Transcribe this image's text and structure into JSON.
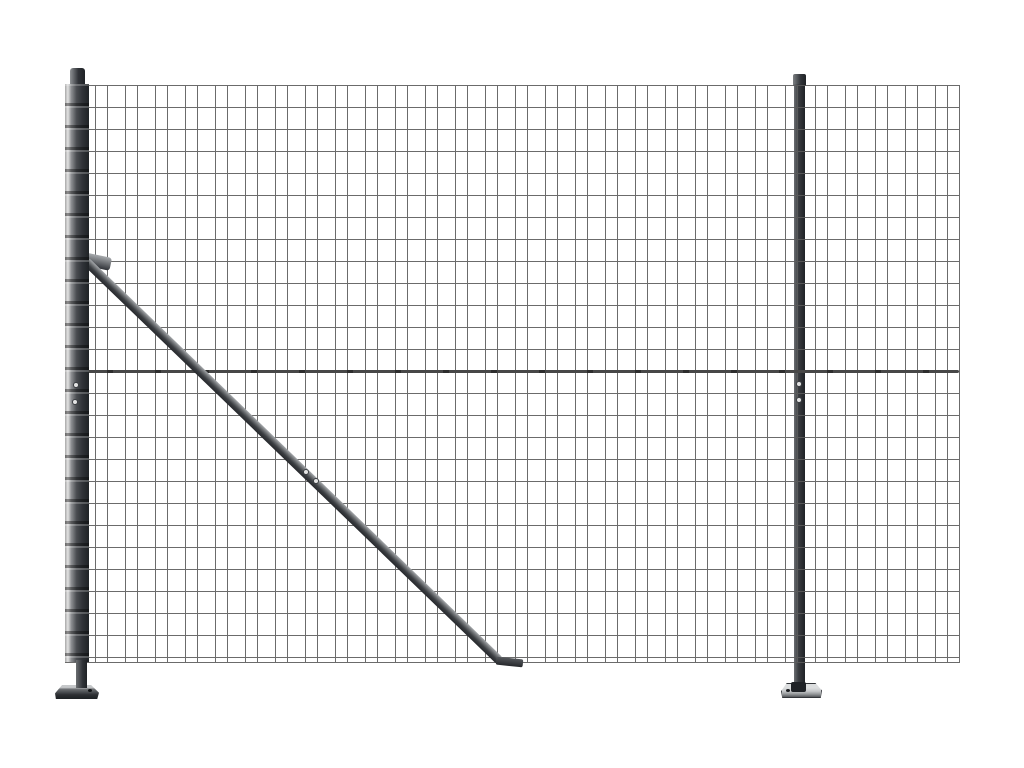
{
  "scene": {
    "type": "product-photo",
    "subject": "anthracite wire mesh fence panel with two posts, flange feet and a diagonal ground brace",
    "background": "#ffffff"
  },
  "colors": {
    "bg": "#ffffff",
    "wire": "#5c5c5c",
    "tension": "#474747",
    "tension_dark": "#2d2d2d",
    "post_light": "#e3e3e3",
    "post_dark": "#303338",
    "post_darker": "#1f2226",
    "brace_light": "#a7aaad",
    "brace_dark": "#26282c",
    "flange_light": "#c6c8ca",
    "flange_dark": "#2c2f33",
    "bolt": "#e4e4e4"
  },
  "mesh": {
    "columns_pattern": "paired vertical wires, pair gap 12px, period 30px",
    "row_spacing_px": 22,
    "panel": {
      "left": 65,
      "top": 85,
      "width": 894,
      "height": 577
    }
  }
}
